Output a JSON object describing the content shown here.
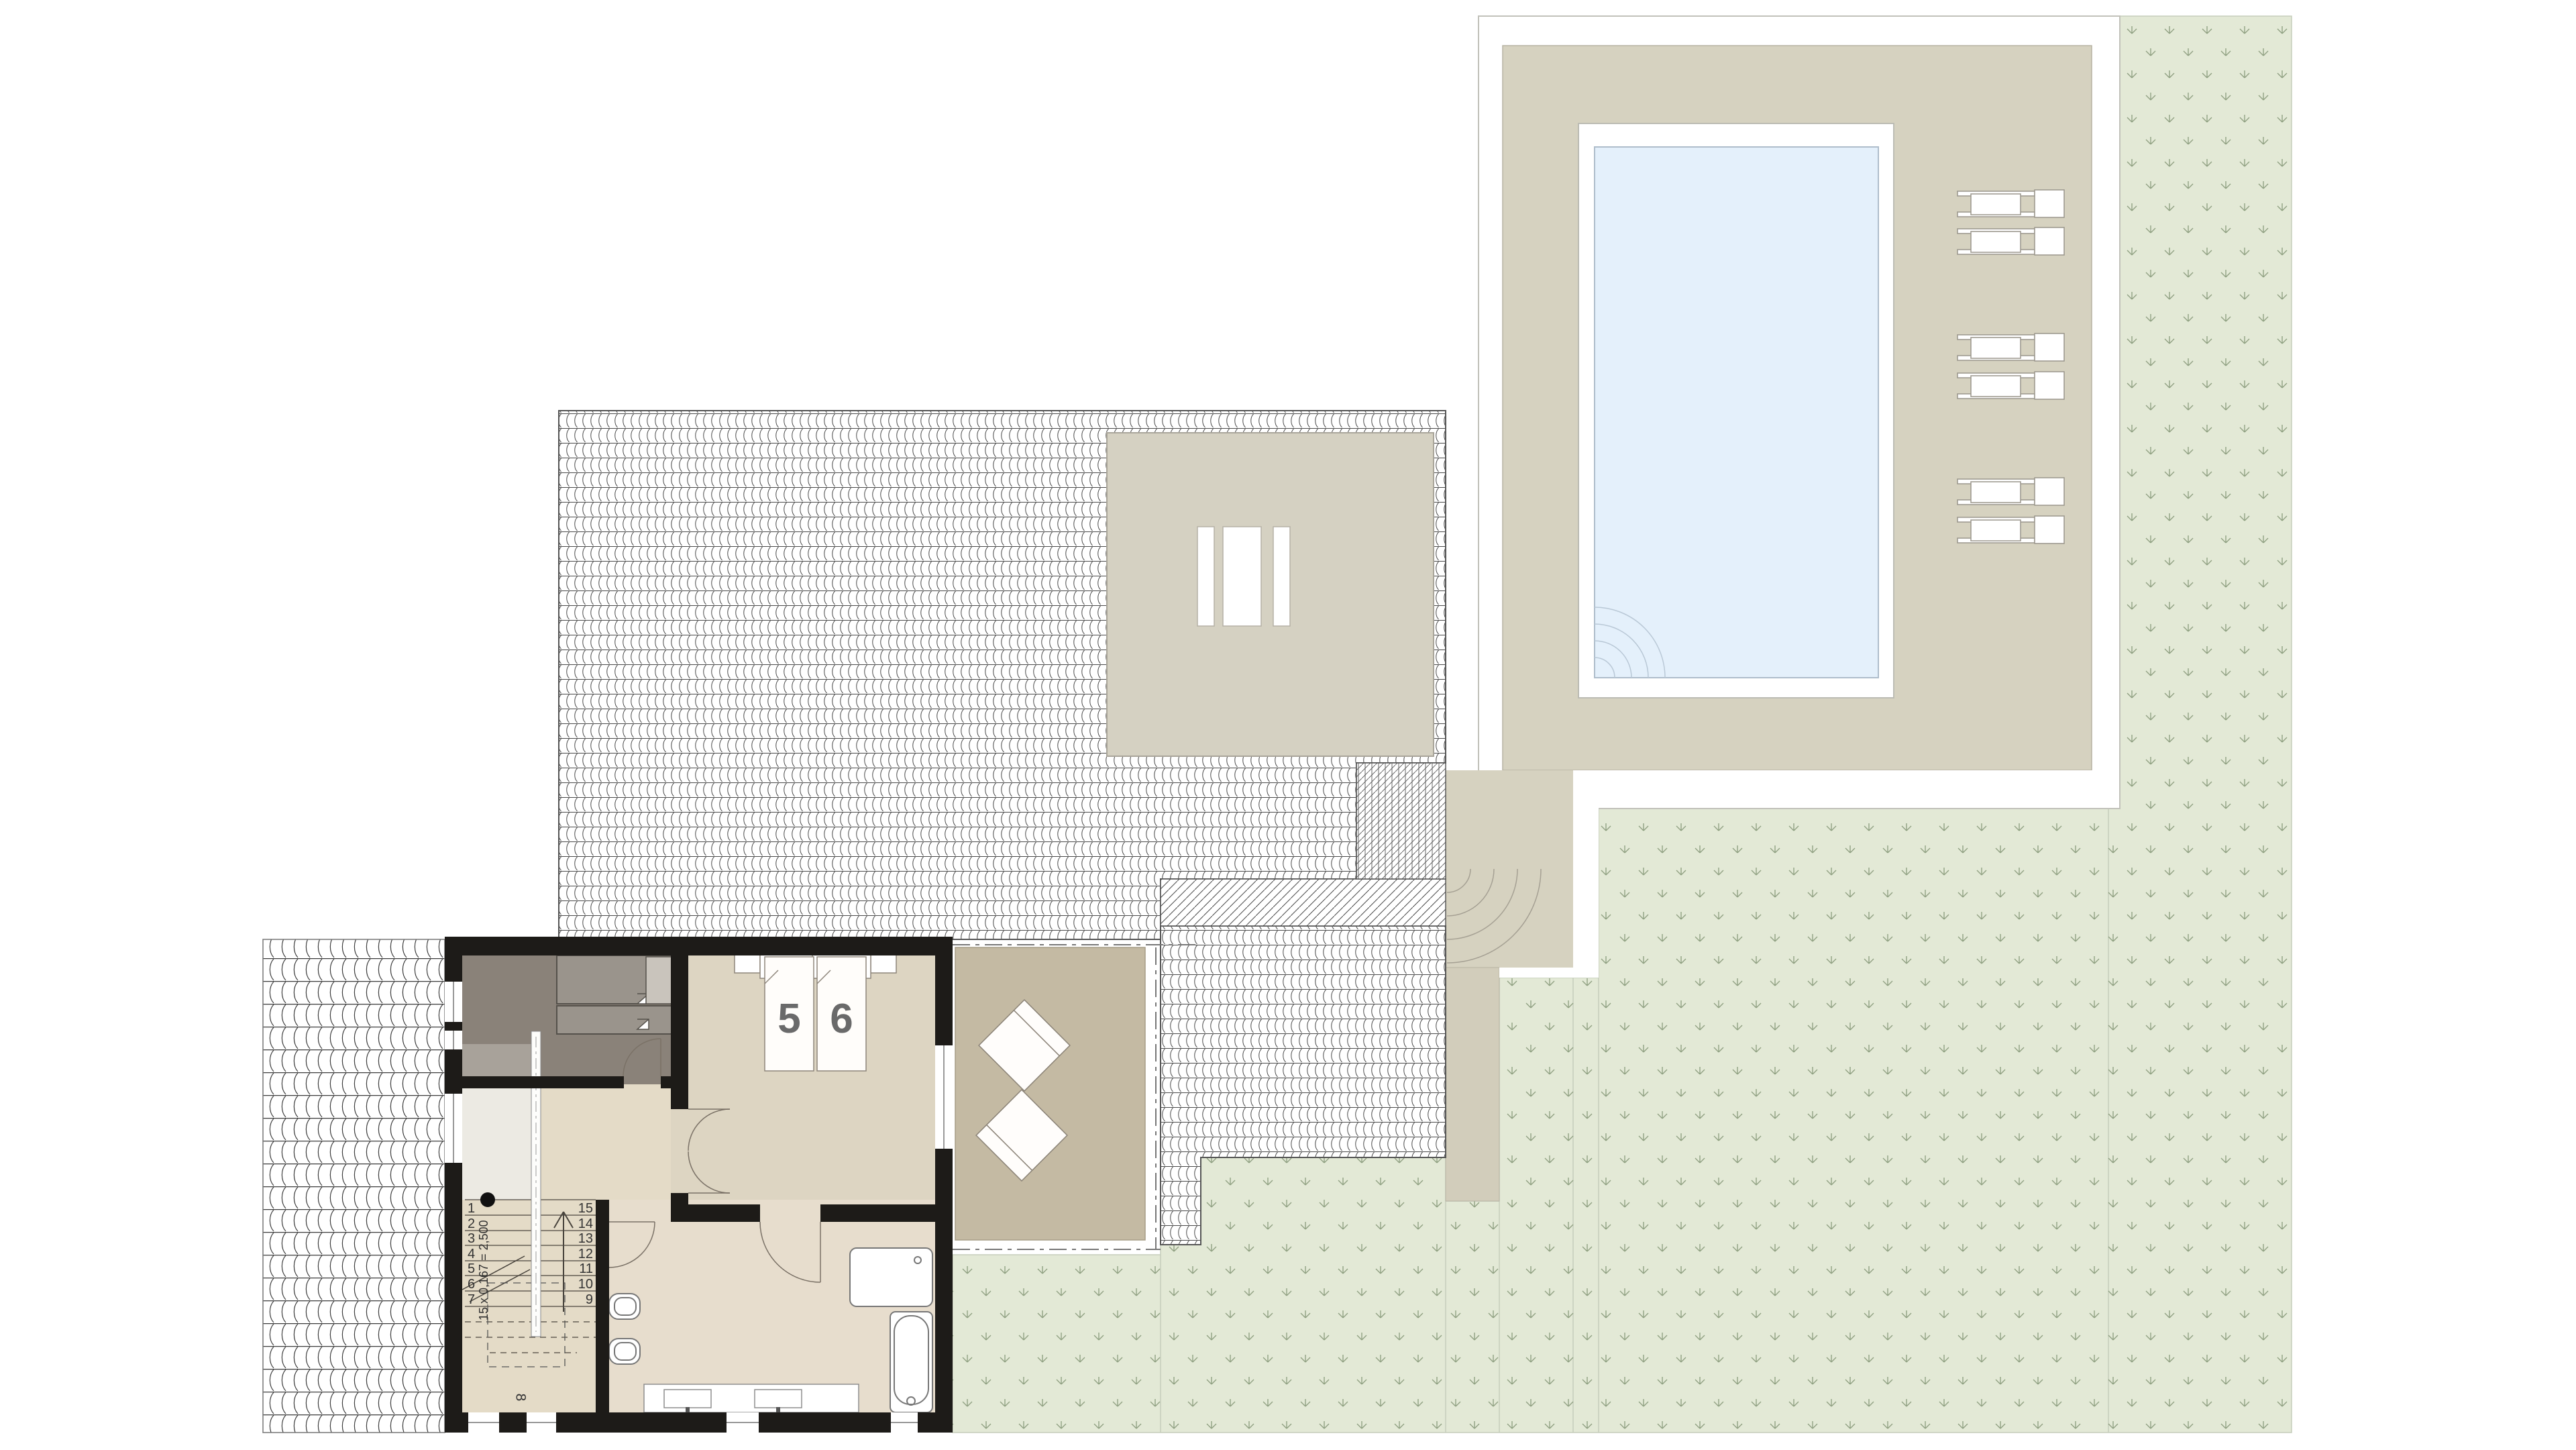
{
  "document": {
    "kind": "architectural site and floor plan",
    "visible_text_summary": "bed numbers, stair step numbers, stair formula, landing number"
  },
  "bedroom": {
    "bed_numbers": [
      "5",
      "6"
    ]
  },
  "stairs": {
    "left_steps": [
      "1",
      "2",
      "3",
      "4",
      "5",
      "6",
      "7"
    ],
    "right_steps": [
      "15",
      "14",
      "13",
      "12",
      "11",
      "10",
      "9"
    ],
    "annotation": "15 x 0,167 = 2,500",
    "landing_label": "8"
  },
  "features": {
    "pool": "swimming-pool",
    "pool_corner_steps": "quarter-circle-steps",
    "sun_loungers_count": 6,
    "skylights_count": 3,
    "terrace_loungers_count": 2,
    "toilets_count": 2,
    "sinks_count": 2,
    "shower_count": 1,
    "bathtub_count": 1,
    "gray_room_beds_count": 2
  },
  "colors": {
    "deck_beige": "#d6d2c0",
    "flat_roof_beige": "#d5d1c2",
    "terrace_tan": "#c4baa3",
    "path_beige": "#d2cdbb",
    "grass_green": "#e3e9d6",
    "grass_glyph": "#90a182",
    "pool_water": "#e4f0fb",
    "wall_black": "#1d1b18",
    "gray_room_floor": "#8a8279",
    "gray_bed": "#9a948c",
    "corridor_floor": "#eceae3",
    "stair_floor": "#e4dbc7",
    "bedroom_floor": "#ddd5c2",
    "bathroom_floor": "#e7ddcd",
    "number_gray": "#6a6a6a"
  }
}
